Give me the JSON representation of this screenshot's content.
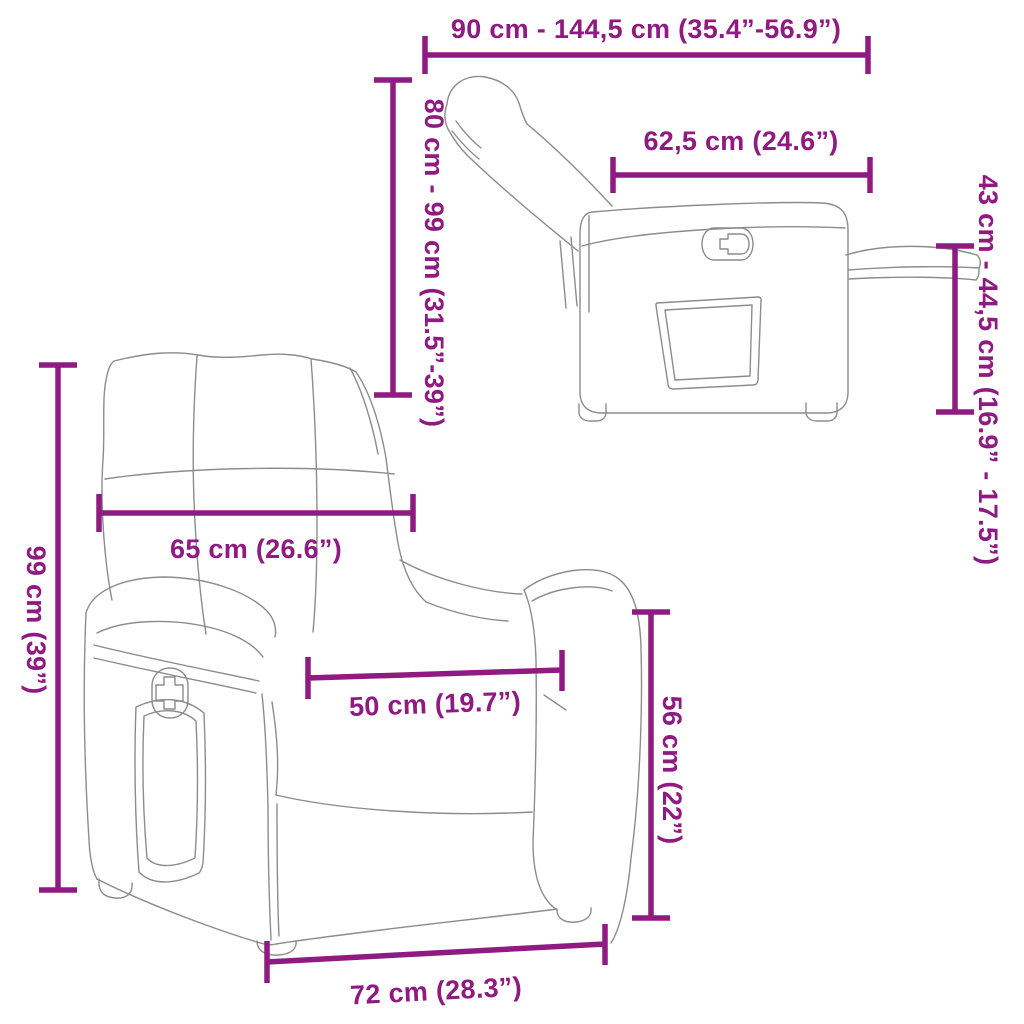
{
  "meta": {
    "description": "Recliner chair dimension diagram with reclined side view and upright front view",
    "views": {
      "side_view_name": "reclined-side-view",
      "front_view_name": "upright-front-view"
    }
  },
  "colors": {
    "accent": "#8E1A82",
    "chair_line": "#8C8C8C",
    "background": "#FFFFFF"
  },
  "dims": {
    "total_depth_reclined": "90 cm - 144,5 cm (35.4”-56.9”)",
    "seat_unit_depth": "62,5 cm (24.6”)",
    "reclined_height": "80 cm - 99 cm (31.5”-39”)",
    "footrest_height": "43 cm - 44,5 cm (16.9” - 17.5”)",
    "backrest_width": "65 cm (26.6”)",
    "total_height": "99 cm (39”)",
    "seat_width": "50 cm (19.7”)",
    "armrest_height": "56 cm (22”)",
    "base_width": "72 cm (28.3”)"
  }
}
